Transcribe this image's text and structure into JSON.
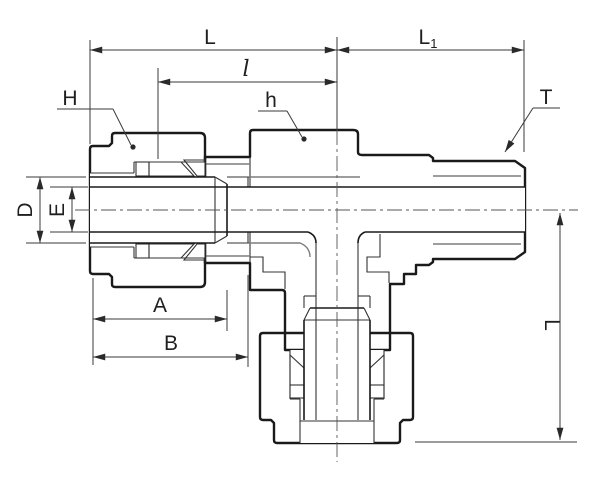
{
  "drawing": {
    "type": "technical-drawing",
    "subject": "branch-tee compression tube fitting cross-section",
    "labels": {
      "L": "L",
      "L1_base": "L",
      "L1_sub": "1",
      "l": "l",
      "H": "H",
      "h": "h",
      "T": "T",
      "D": "D",
      "E": "E",
      "A": "A",
      "B": "B",
      "L_vertical": "L"
    },
    "colors": {
      "outline": "#1a1a1a",
      "dimension_lines": "#3a3a3a",
      "body_fill": "#e9e9e9",
      "body_hatch": "#c6c6c6",
      "nut_fill": "#dedede",
      "nut_hatch": "#aeaeae",
      "background": "#ffffff"
    }
  }
}
